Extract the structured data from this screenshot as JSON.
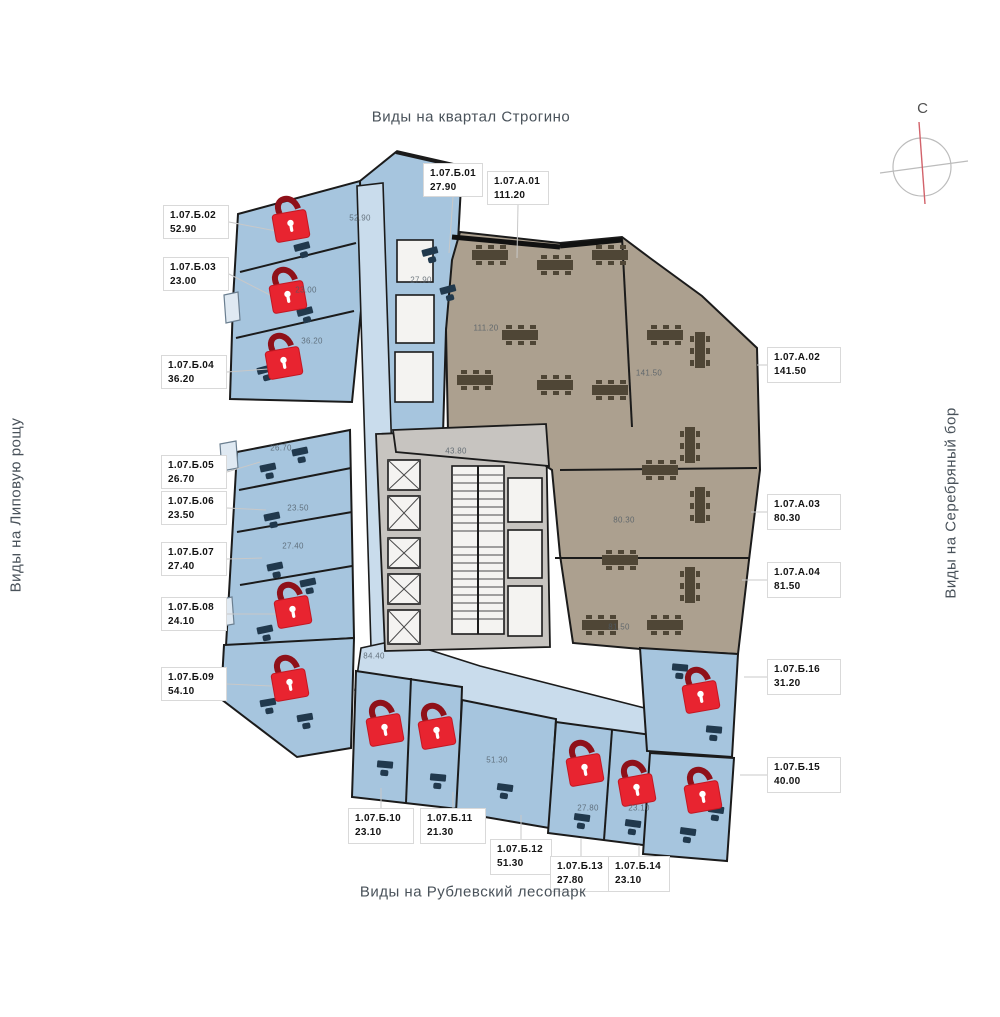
{
  "titles": {
    "top": "Виды на квартал Строгино",
    "bottom": "Виды на Рублевский лесопарк",
    "left": "Виды на Липовую рощу",
    "right": "Виды на Серебряный бор"
  },
  "compass": {
    "label": "С"
  },
  "colors": {
    "unit_blue": "#a6c5de",
    "corridor_blue": "#c9dcec",
    "office_taupe": "#aca08f",
    "core_gray": "#c7c4c0",
    "lock_red": "#e82430",
    "lock_shackle": "#8f1119",
    "wall": "#1b1b1b"
  },
  "units": [
    {
      "id": "1.07.Б.01",
      "area": "27.90",
      "locked": false,
      "side": "top",
      "box": {
        "x": 423,
        "y": 163,
        "w": 60,
        "h": 34
      },
      "anchor": {
        "x": 449,
        "y": 253
      }
    },
    {
      "id": "1.07.А.01",
      "area": "111.20",
      "locked": false,
      "side": "top",
      "box": {
        "x": 487,
        "y": 171,
        "w": 62,
        "h": 34
      },
      "anchor": {
        "x": 517,
        "y": 258
      }
    },
    {
      "id": "1.07.Б.02",
      "area": "52.90",
      "locked": true,
      "side": "left",
      "box": {
        "x": 163,
        "y": 205,
        "w": 66,
        "h": 34
      },
      "anchor": {
        "x": 276,
        "y": 231
      },
      "lock": {
        "x": 291,
        "y": 226
      }
    },
    {
      "id": "1.07.Б.03",
      "area": "23.00",
      "locked": true,
      "side": "left",
      "box": {
        "x": 163,
        "y": 257,
        "w": 66,
        "h": 34
      },
      "anchor": {
        "x": 272,
        "y": 296
      },
      "lock": {
        "x": 288,
        "y": 297
      }
    },
    {
      "id": "1.07.Б.04",
      "area": "36.20",
      "locked": true,
      "side": "left",
      "box": {
        "x": 161,
        "y": 355,
        "w": 66,
        "h": 34
      },
      "anchor": {
        "x": 268,
        "y": 369
      },
      "lock": {
        "x": 284,
        "y": 363
      }
    },
    {
      "id": "1.07.Б.05",
      "area": "26.70",
      "locked": false,
      "side": "left",
      "box": {
        "x": 161,
        "y": 455,
        "w": 66,
        "h": 34
      },
      "anchor": {
        "x": 260,
        "y": 462
      }
    },
    {
      "id": "1.07.Б.06",
      "area": "23.50",
      "locked": false,
      "side": "left",
      "box": {
        "x": 161,
        "y": 491,
        "w": 66,
        "h": 34
      },
      "anchor": {
        "x": 266,
        "y": 510
      }
    },
    {
      "id": "1.07.Б.07",
      "area": "27.40",
      "locked": false,
      "side": "left",
      "box": {
        "x": 161,
        "y": 542,
        "w": 66,
        "h": 34
      },
      "anchor": {
        "x": 262,
        "y": 558
      }
    },
    {
      "id": "1.07.Б.08",
      "area": "24.10",
      "locked": true,
      "side": "left",
      "box": {
        "x": 161,
        "y": 597,
        "w": 66,
        "h": 34
      },
      "anchor": {
        "x": 276,
        "y": 614
      },
      "lock": {
        "x": 293,
        "y": 612
      }
    },
    {
      "id": "1.07.Б.09",
      "area": "54.10",
      "locked": true,
      "side": "left",
      "box": {
        "x": 161,
        "y": 667,
        "w": 66,
        "h": 34
      },
      "anchor": {
        "x": 272,
        "y": 686
      },
      "lock": {
        "x": 290,
        "y": 685
      }
    },
    {
      "id": "1.07.Б.10",
      "area": "23.10",
      "locked": true,
      "side": "bottom",
      "box": {
        "x": 348,
        "y": 808,
        "w": 66,
        "h": 36
      },
      "anchor": {
        "x": 381,
        "y": 788
      },
      "lock": {
        "x": 385,
        "y": 730
      }
    },
    {
      "id": "1.07.Б.11",
      "area": "21.30",
      "locked": true,
      "side": "bottom",
      "box": {
        "x": 420,
        "y": 808,
        "w": 66,
        "h": 36
      },
      "anchor": {
        "x": 453,
        "y": 792
      },
      "lock": {
        "x": 437,
        "y": 733
      }
    },
    {
      "id": "1.07.Б.12",
      "area": "51.30",
      "locked": false,
      "side": "bottom",
      "box": {
        "x": 490,
        "y": 839,
        "w": 62,
        "h": 36
      },
      "anchor": {
        "x": 521,
        "y": 815
      }
    },
    {
      "id": "1.07.Б.13",
      "area": "27.80",
      "locked": true,
      "side": "bottom",
      "box": {
        "x": 550,
        "y": 856,
        "w": 62,
        "h": 36
      },
      "anchor": {
        "x": 581,
        "y": 838
      },
      "lock": {
        "x": 585,
        "y": 770
      }
    },
    {
      "id": "1.07.Б.14",
      "area": "23.10",
      "locked": true,
      "side": "bottom",
      "box": {
        "x": 608,
        "y": 856,
        "w": 62,
        "h": 36
      },
      "anchor": {
        "x": 639,
        "y": 845
      },
      "lock": {
        "x": 637,
        "y": 790
      }
    },
    {
      "id": "1.07.Б.15",
      "area": "40.00",
      "locked": true,
      "side": "right",
      "box": {
        "x": 767,
        "y": 757,
        "w": 74,
        "h": 36
      },
      "anchor": {
        "x": 740,
        "y": 775
      },
      "lock": {
        "x": 703,
        "y": 797
      }
    },
    {
      "id": "1.07.Б.16",
      "area": "31.20",
      "locked": true,
      "side": "right",
      "box": {
        "x": 767,
        "y": 659,
        "w": 74,
        "h": 36
      },
      "anchor": {
        "x": 744,
        "y": 677
      },
      "lock": {
        "x": 701,
        "y": 697
      }
    },
    {
      "id": "1.07.А.02",
      "area": "141.50",
      "locked": false,
      "side": "right",
      "box": {
        "x": 767,
        "y": 347,
        "w": 74,
        "h": 36
      },
      "anchor": {
        "x": 757,
        "y": 365
      }
    },
    {
      "id": "1.07.А.03",
      "area": "80.30",
      "locked": false,
      "side": "right",
      "box": {
        "x": 767,
        "y": 494,
        "w": 74,
        "h": 36
      },
      "anchor": {
        "x": 751,
        "y": 512
      }
    },
    {
      "id": "1.07.А.04",
      "area": "81.50",
      "locked": false,
      "side": "right",
      "box": {
        "x": 767,
        "y": 562,
        "w": 74,
        "h": 36
      },
      "anchor": {
        "x": 742,
        "y": 580
      }
    }
  ],
  "plan_area_labels": [
    {
      "text": "52.90",
      "x": 360,
      "y": 218
    },
    {
      "text": "23.00",
      "x": 306,
      "y": 290
    },
    {
      "text": "36.20",
      "x": 312,
      "y": 341
    },
    {
      "text": "27.90",
      "x": 421,
      "y": 280
    },
    {
      "text": "111.20",
      "x": 486,
      "y": 328
    },
    {
      "text": "141.50",
      "x": 649,
      "y": 373
    },
    {
      "text": "26.70",
      "x": 281,
      "y": 448
    },
    {
      "text": "23.50",
      "x": 298,
      "y": 508
    },
    {
      "text": "27.40",
      "x": 293,
      "y": 546
    },
    {
      "text": "43.80",
      "x": 456,
      "y": 451
    },
    {
      "text": "80.30",
      "x": 624,
      "y": 520
    },
    {
      "text": "81.50",
      "x": 619,
      "y": 627
    },
    {
      "text": "84.40",
      "x": 374,
      "y": 656
    },
    {
      "text": "51.30",
      "x": 497,
      "y": 760
    },
    {
      "text": "27.80",
      "x": 588,
      "y": 808
    },
    {
      "text": "23.10",
      "x": 639,
      "y": 808
    }
  ]
}
